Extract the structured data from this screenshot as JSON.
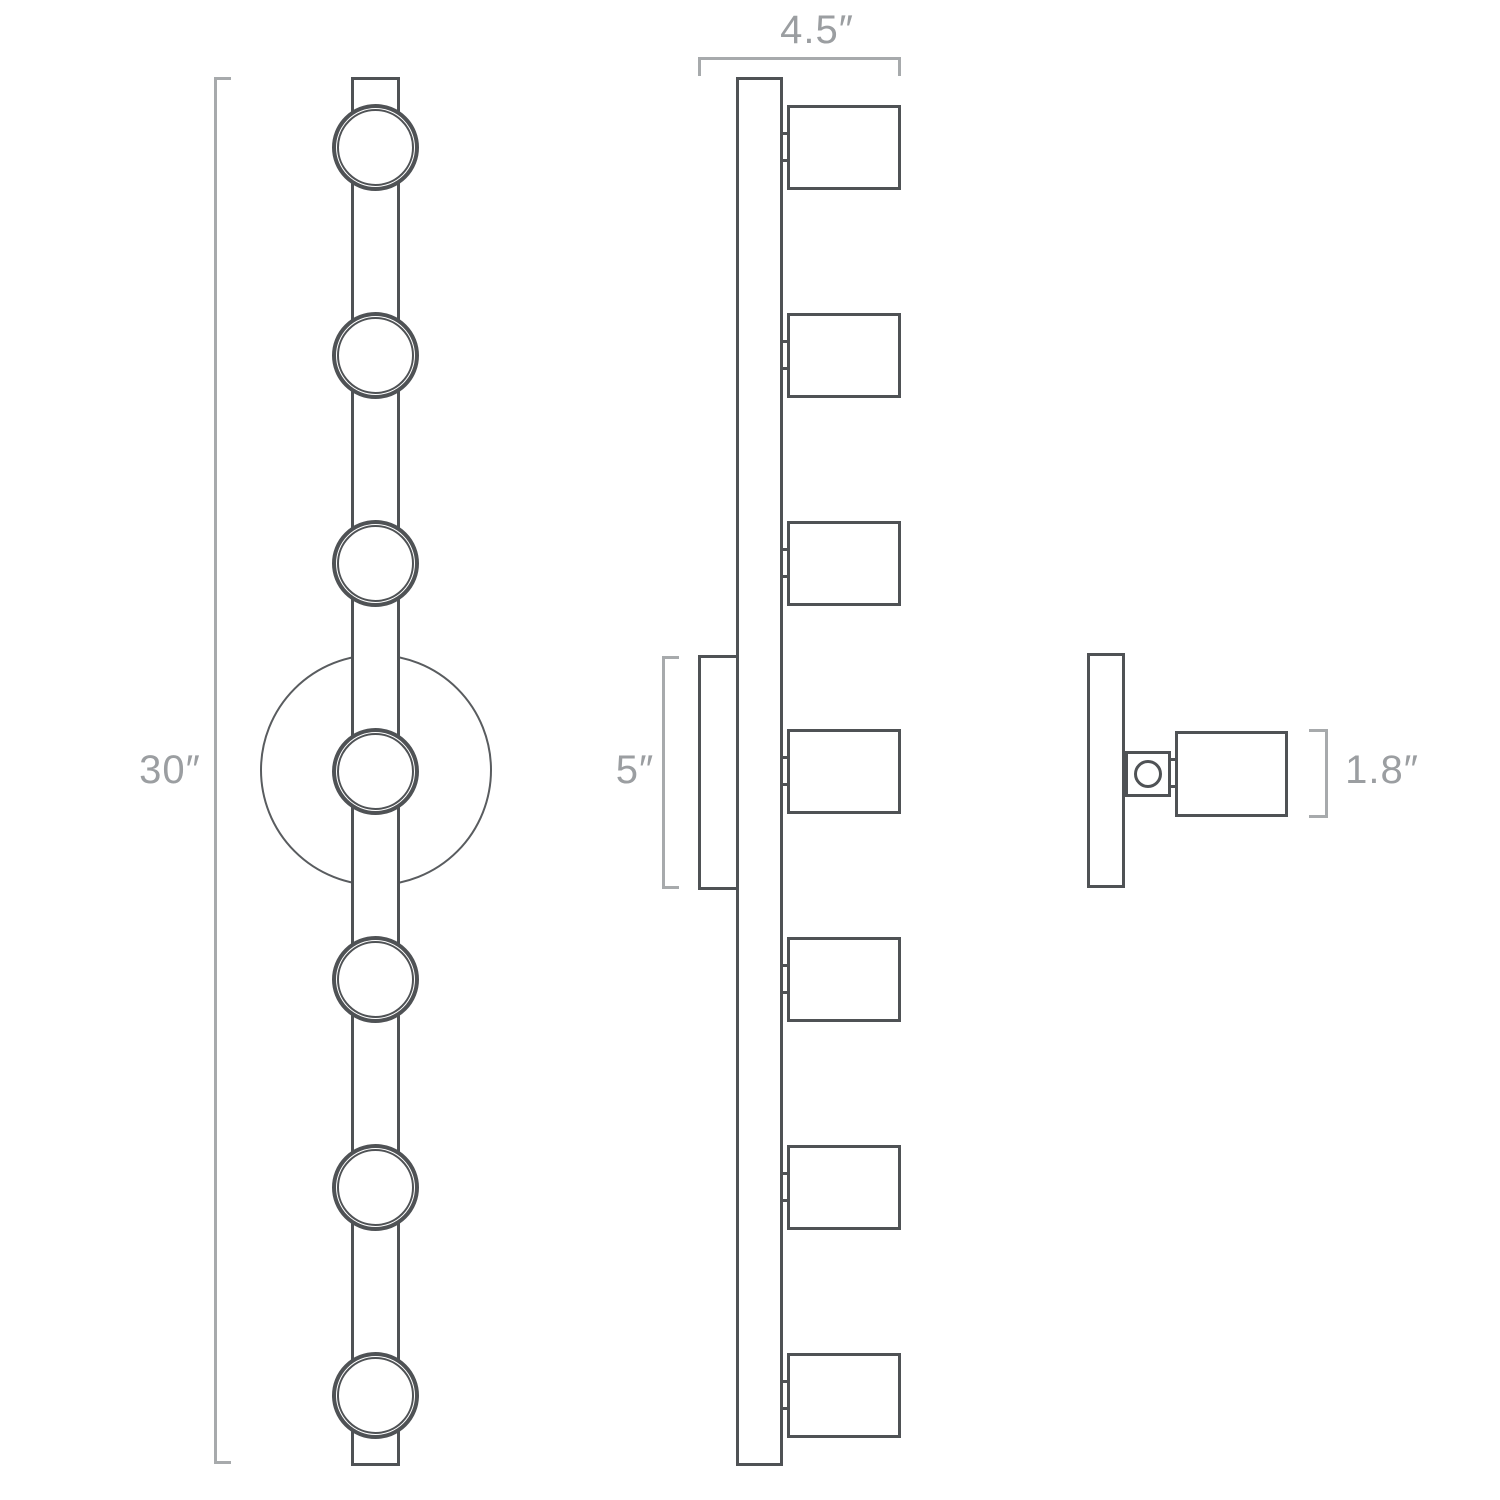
{
  "page": {
    "description": "Three-view technical dimension drawing of a seven-light linear wall fixture with round canopy and cylindrical swivel lamps"
  },
  "colors": {
    "line_dark": "#4f5255",
    "line_dim": "#a7aaac",
    "label_text": "#9b9ea1",
    "background": "#ffffff"
  },
  "views": {
    "front": {
      "name": "front elevation",
      "lights_count": 7,
      "height_label": "30″"
    },
    "side": {
      "name": "side profile",
      "lights_count": 7,
      "depth_label": "4.5″",
      "canopy_label": "5″"
    },
    "detail": {
      "name": "single lamp detail",
      "lamp_label": "1.8″"
    }
  }
}
